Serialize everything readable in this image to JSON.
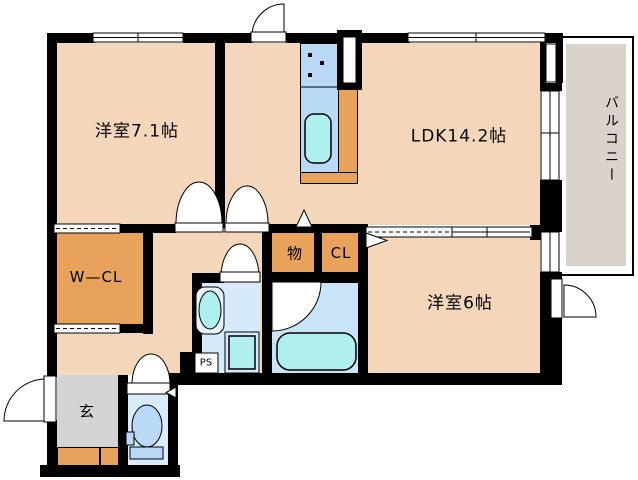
{
  "plan": {
    "title": "2LDK apartment floor plan",
    "rooms": {
      "western_room_71": {
        "label": "洋室7.1帖"
      },
      "ldk": {
        "label": "LDK14.2帖"
      },
      "western_room_6": {
        "label": "洋室6帖"
      },
      "balcony": {
        "label": "バルコニー"
      },
      "walk_in_closet": {
        "label": "W—CL"
      },
      "storage": {
        "label": "物"
      },
      "closet": {
        "label": "CL"
      },
      "entrance": {
        "label": "玄"
      },
      "pipe_space": {
        "label": "PS"
      }
    },
    "colors": {
      "floor_peach": "#f4d6ba",
      "wall_black": "#000000",
      "closet_orange": "#e9a25b",
      "kitchen_counter_blue": "#b9d9f7",
      "fixture_cyan": "#aff0ef",
      "washroom_blue": "#d6eafc",
      "bathroom_blue": "#c9e3f7",
      "toilet_blue": "#d9ecfc",
      "entrance_gray": "#d4d4d4",
      "balcony_gray": "#dad3cb"
    }
  }
}
